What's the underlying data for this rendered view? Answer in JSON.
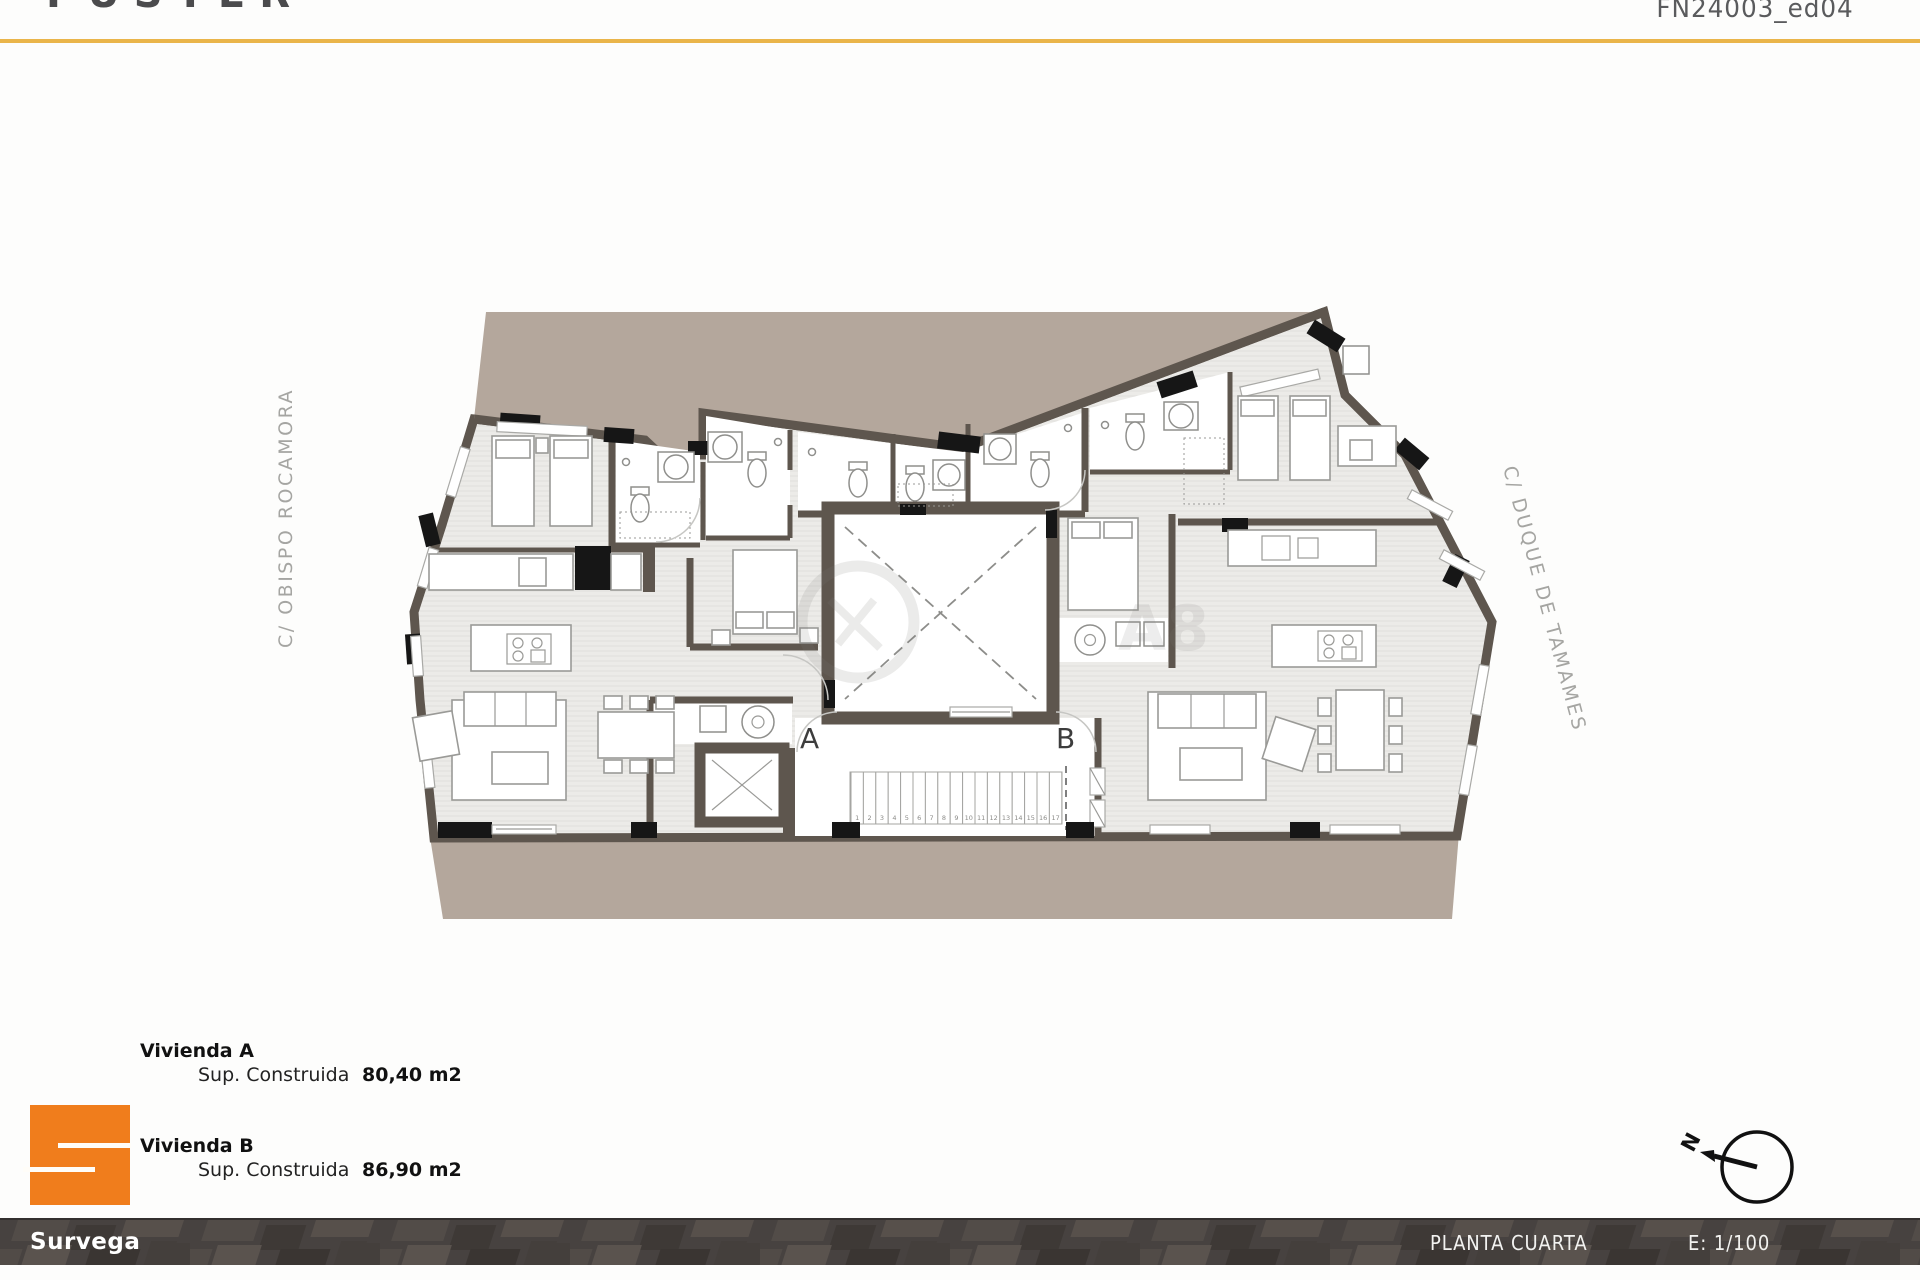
{
  "header": {
    "logo": "FUSTER",
    "code": "FN24003_ed04"
  },
  "plan": {
    "street_left": "C/ OBISPO ROCAMORA",
    "street_right": "C/ DUQUE DE TAMAMES",
    "unit_a_label": "A",
    "unit_b_label": "B",
    "stair_treads": [
      1,
      2,
      3,
      4,
      5,
      6,
      7,
      8,
      9,
      10,
      11,
      12,
      13,
      14,
      15,
      16,
      17
    ],
    "watermark": "A8",
    "compass_label": "N"
  },
  "legend": {
    "items": [
      {
        "name": "Vivienda A",
        "metric": "Sup. Construida",
        "value": "80,40 m2"
      },
      {
        "name": "Vivienda B",
        "metric": "Sup. Construida",
        "value": "86,90 m2"
      }
    ]
  },
  "footer": {
    "company": "Survega",
    "sheet_title": "PLANTA CUARTA",
    "scale": "E: 1/100"
  },
  "colors": {
    "accent_yellow": "#eab54a",
    "brand_orange": "#f07d1c",
    "site_beige": "#b4a79c",
    "wall": "#5e564e",
    "footer_bg": "#474240"
  }
}
